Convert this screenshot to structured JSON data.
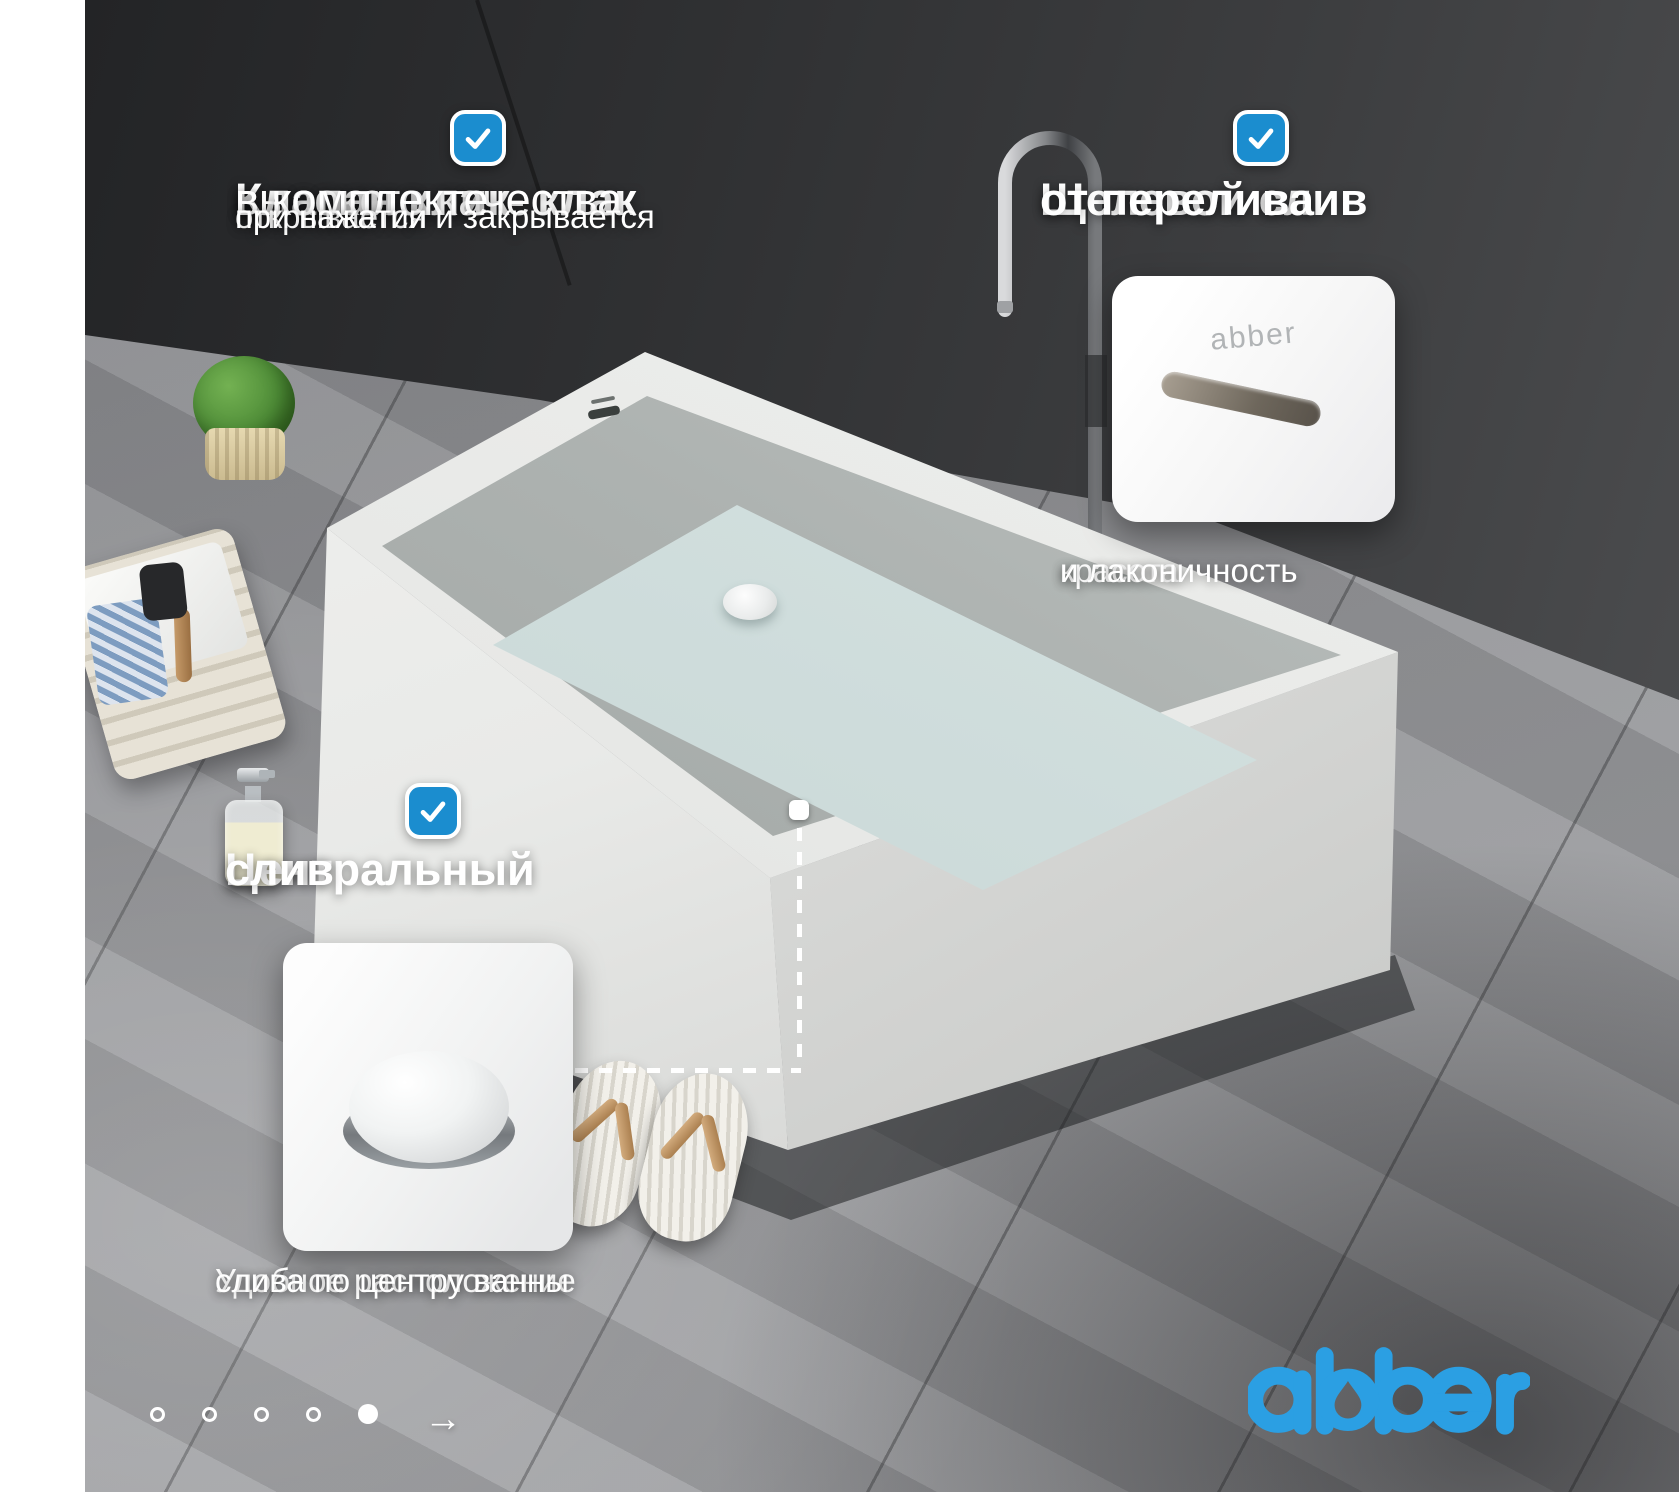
{
  "brand": {
    "logo_text": "abber",
    "logo_color": "#2b9fe3"
  },
  "features": {
    "clickclack": {
      "title_bold": "Клапан клик- клак",
      "title_line2": "высокого качества",
      "title_line3": "в комплекте",
      "note_line1": "открывается и закрывается",
      "note_line2": "при нажатии"
    },
    "overflow": {
      "title_line1": "Щелевой слив",
      "title_line2": "от перелива",
      "inset_logo": "abber",
      "caption_line1": "красота",
      "caption_line2": "и лаконичность"
    },
    "central_drain": {
      "title_line1": "Центральный",
      "title_line2": "слив",
      "caption_line1": "Удобное расположение",
      "caption_line2": "слива по центру ванны"
    }
  },
  "carousel": {
    "dot_count": 5,
    "active_index": 4,
    "next_label": "→"
  },
  "colors": {
    "checkbox_blue": "#1b8dcf",
    "accent_blue": "#2b9fe3"
  }
}
